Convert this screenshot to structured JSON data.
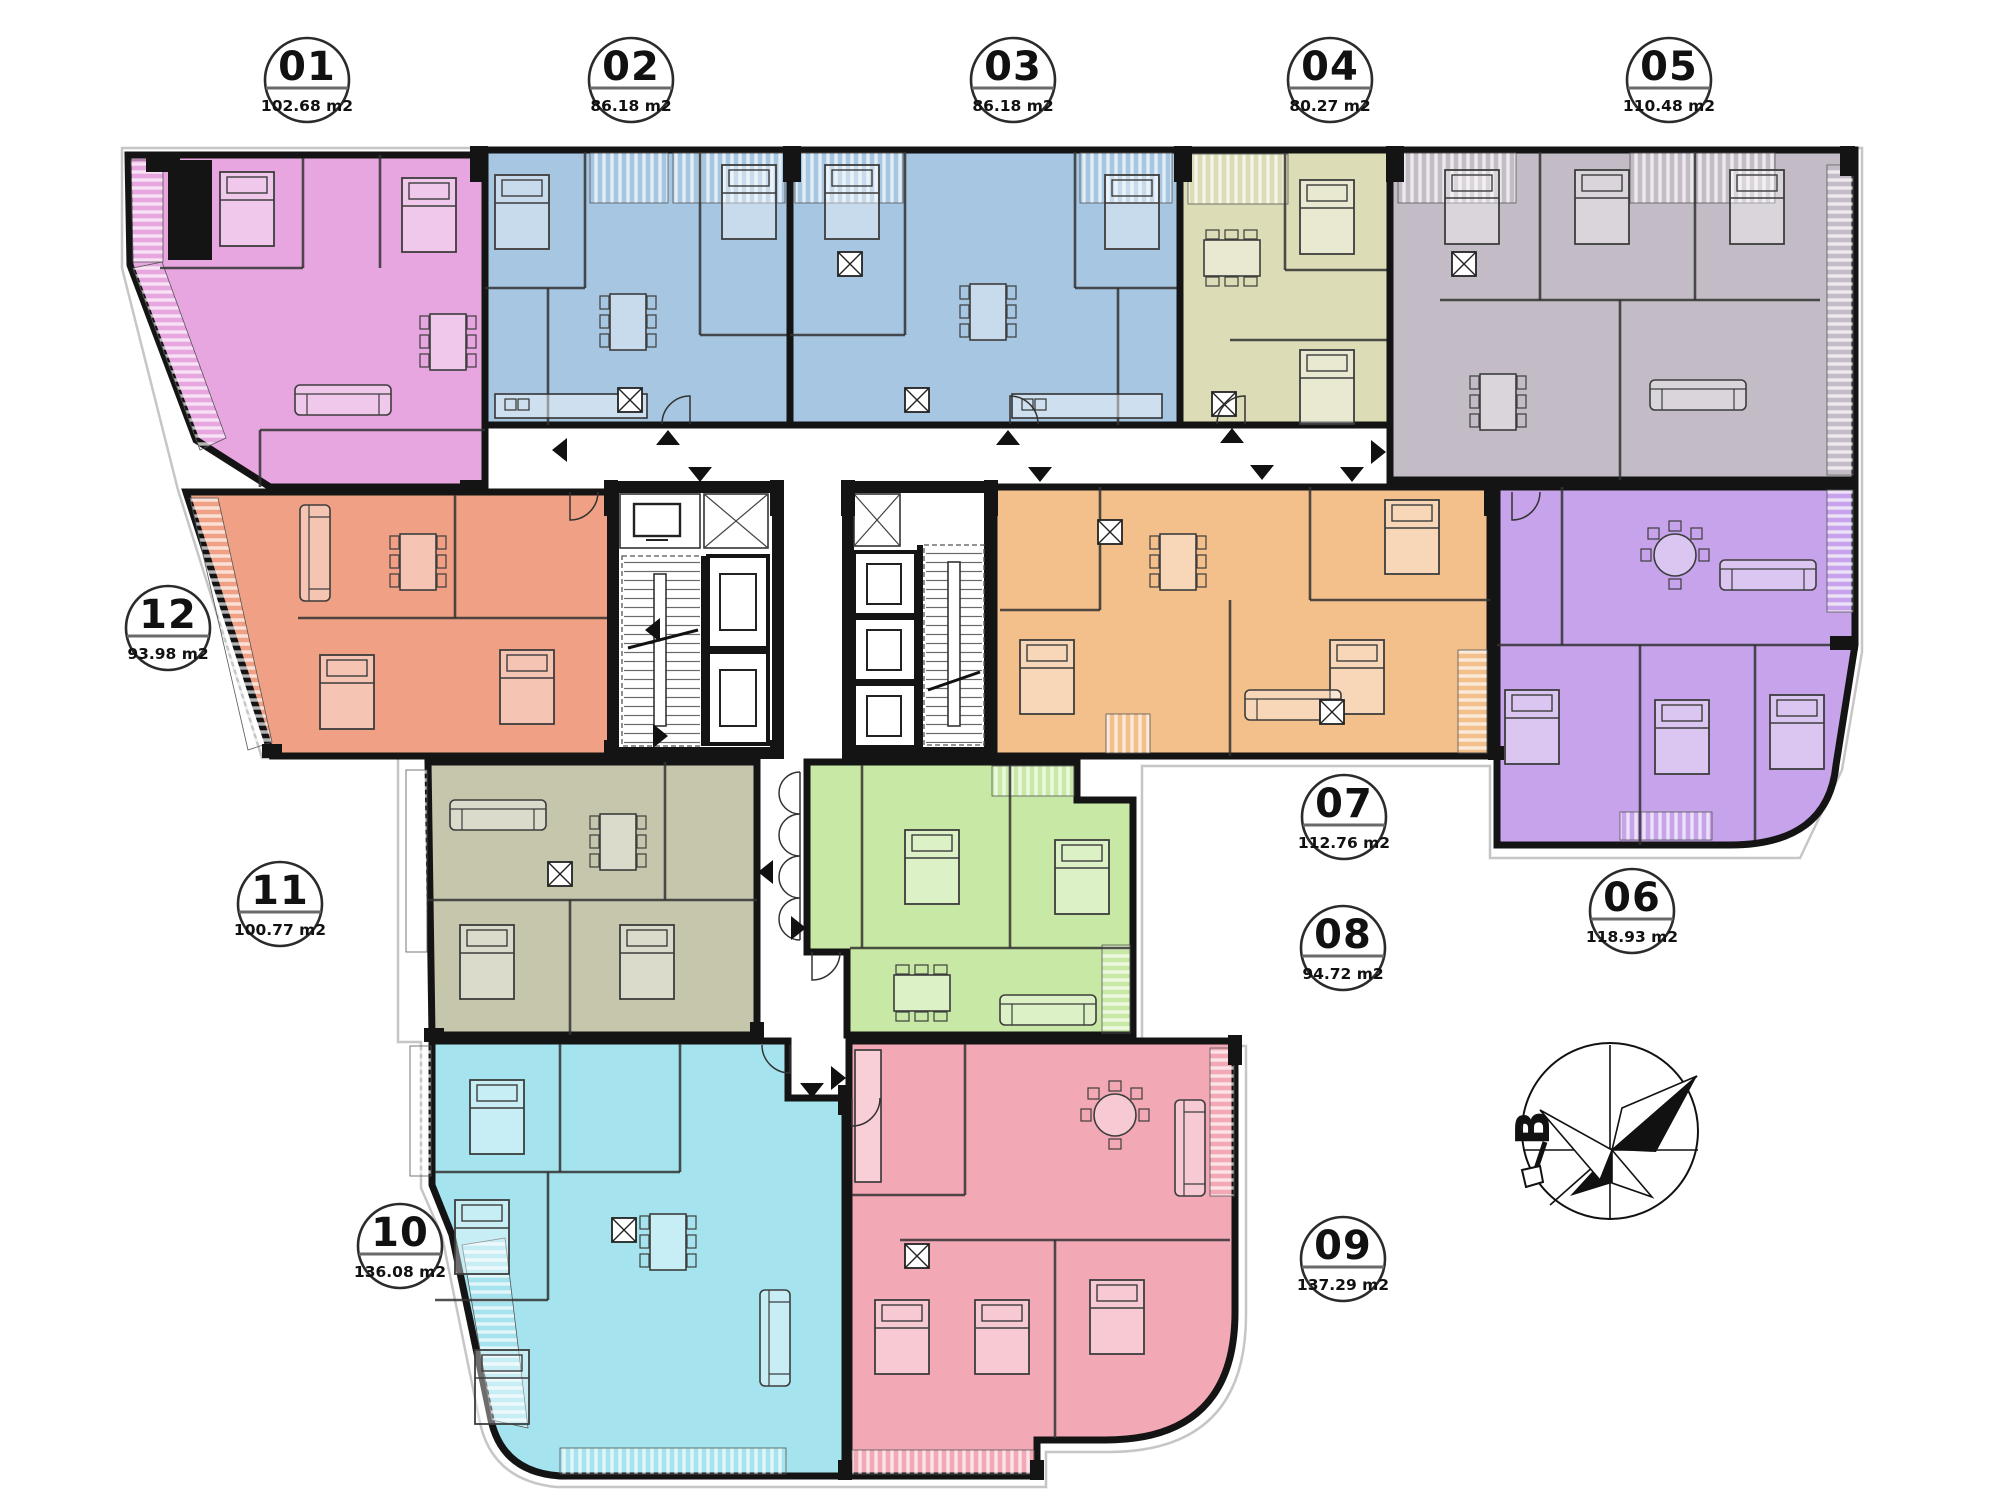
{
  "plan": {
    "type": "apartment-floor-plan",
    "area_unit_suffix": "m2"
  },
  "colors": {
    "wall": "#141414",
    "site_outline": "#c6c6c6",
    "paper": "#ffffff"
  },
  "units": [
    {
      "id": "01",
      "area": "102.68 m2",
      "color": "#e7a6df"
    },
    {
      "id": "02",
      "area": "86.18 m2",
      "color": "#a6c6e2"
    },
    {
      "id": "03",
      "area": "86.18 m2",
      "color": "#a6c6e2"
    },
    {
      "id": "04",
      "area": "80.27 m2",
      "color": "#dcdcb6"
    },
    {
      "id": "05",
      "area": "110.48 m2",
      "color": "#c3bcc6"
    },
    {
      "id": "06",
      "area": "118.93 m2",
      "color": "#c6a3ea"
    },
    {
      "id": "07",
      "area": "112.76 m2",
      "color": "#f3bf8b"
    },
    {
      "id": "08",
      "area": "94.72 m2",
      "color": "#c8e9a5"
    },
    {
      "id": "09",
      "area": "137.29 m2",
      "color": "#f3a8b6"
    },
    {
      "id": "10",
      "area": "136.08 m2",
      "color": "#a5e4ee"
    },
    {
      "id": "11",
      "area": "100.77 m2",
      "color": "#c6c6ac"
    },
    {
      "id": "12",
      "area": "93.98 m2",
      "color": "#f0a185"
    }
  ],
  "compass": {
    "letter": "B"
  }
}
